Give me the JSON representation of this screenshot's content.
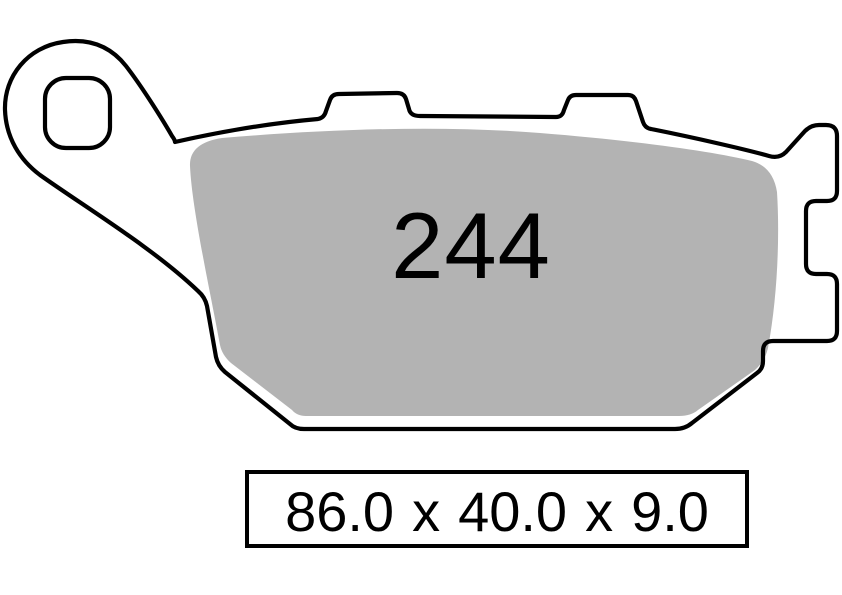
{
  "part_number": "244",
  "dimensions": {
    "width_mm": "86.0",
    "height_mm": "40.0",
    "thickness_mm": "9.0",
    "separator": "x",
    "label": "86.0 x 40.0 x 9.0"
  },
  "colors": {
    "outline": "#000000",
    "pad_fill": "#b3b3b3",
    "background": "#ffffff"
  }
}
